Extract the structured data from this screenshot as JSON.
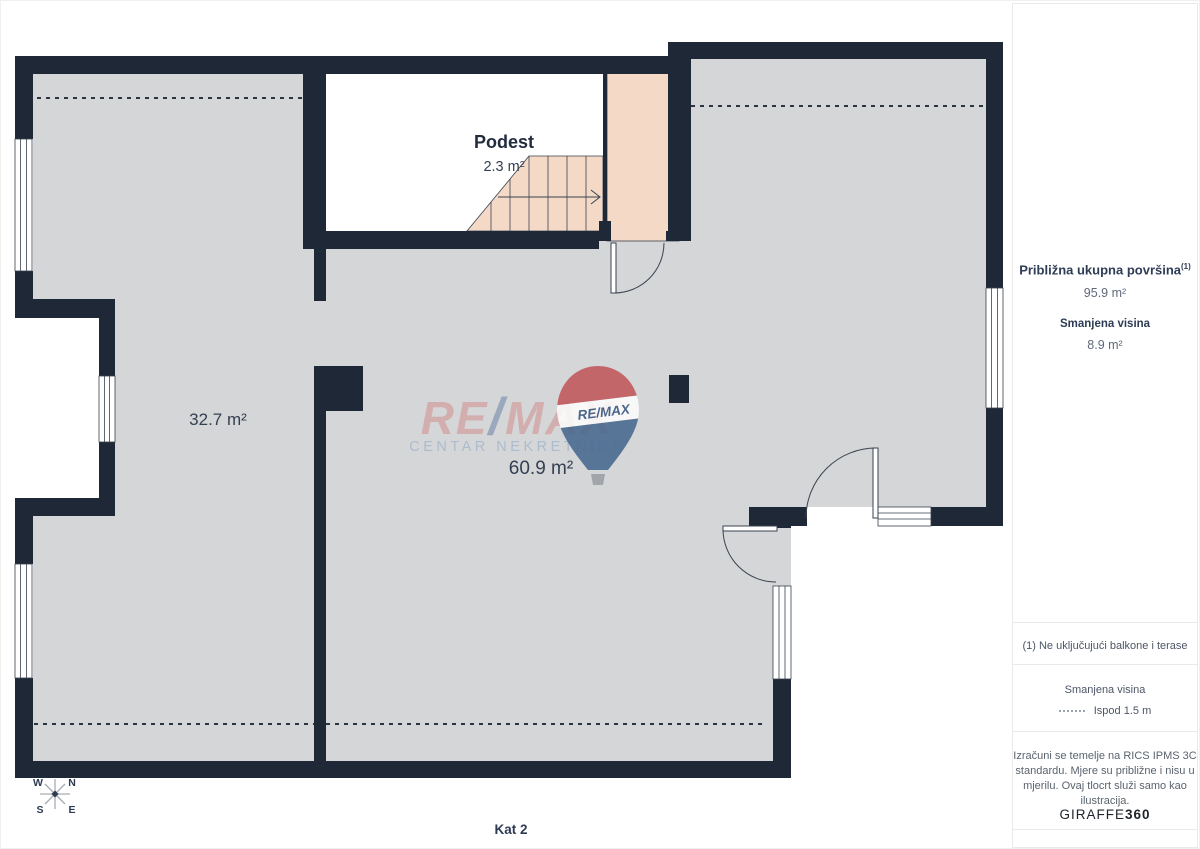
{
  "plan": {
    "floor_label": "Kat 2",
    "podest_label": "Podest",
    "podest_area": "2.3 m²",
    "room_left_area": "32.7 m²",
    "room_main_area": "60.9 m²",
    "compass": {
      "n": "N",
      "s": "S",
      "e": "E",
      "w": "W"
    },
    "colors": {
      "wall": "#1e2836",
      "floor": "#d5d6d7",
      "stairs": "#f4d9c7",
      "reduced_height_line": "#2a3442"
    }
  },
  "watermark": {
    "brand_re": "RE",
    "brand_slash": "/",
    "brand_max": "MAX",
    "subtitle": "CENTAR NEKRETNINA",
    "balloon_text": "RE/MAX",
    "colors": {
      "red": "#c0575c",
      "blue": "#46688f"
    }
  },
  "sidebar": {
    "total_area_label": "Približna ukupna površina",
    "total_area_sup": "(1)",
    "total_area_value": "95.9 m²",
    "reduced_height_label": "Smanjena visina",
    "reduced_height_value": "8.9 m²",
    "footnote": "(1) Ne uključujući balkone i terase",
    "legend_title": "Smanjena visina",
    "legend_item": "Ispod 1.5 m",
    "disclaimer_lines": [
      "Izračuni se temelje na RICS IPMS 3C",
      "standardu. Mjere su približne i nisu u",
      "mjerilu. Ovaj tlocrt služi samo kao",
      "ilustracija."
    ],
    "brand_giraffe": "GIRAFFE",
    "brand_360": "360"
  }
}
